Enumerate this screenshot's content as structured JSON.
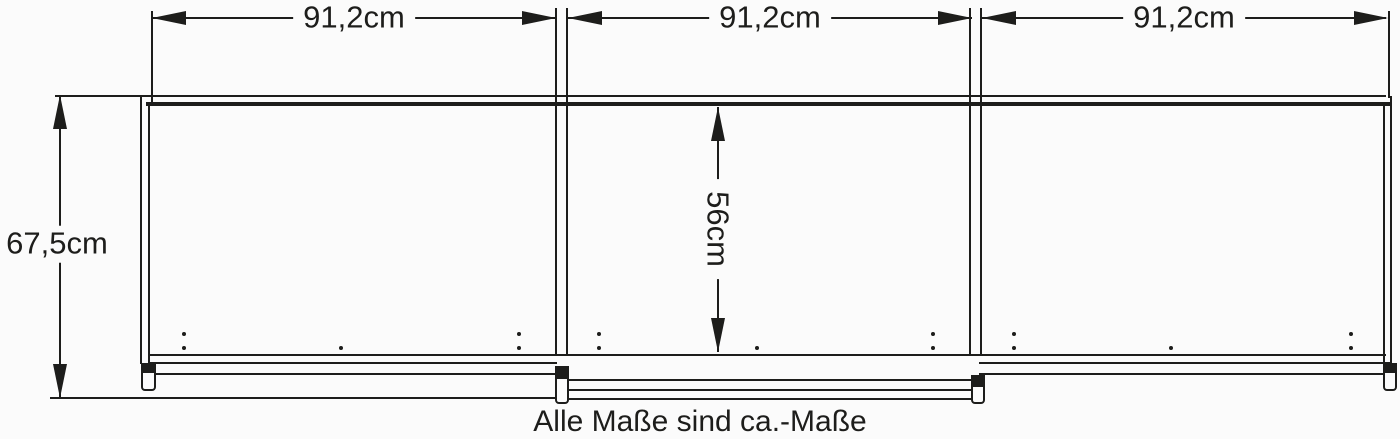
{
  "diagram": {
    "type": "furniture-dimension-drawing",
    "dimensions": {
      "widths": [
        "91,2cm",
        "91,2cm",
        "91,2cm"
      ],
      "height_total": "67,5cm",
      "height_inner": "56cm"
    },
    "footnote": "Alle Maße sind ca.-Maße",
    "colors": {
      "line": "#1d1d1b",
      "background": "#fbfbfb"
    }
  }
}
